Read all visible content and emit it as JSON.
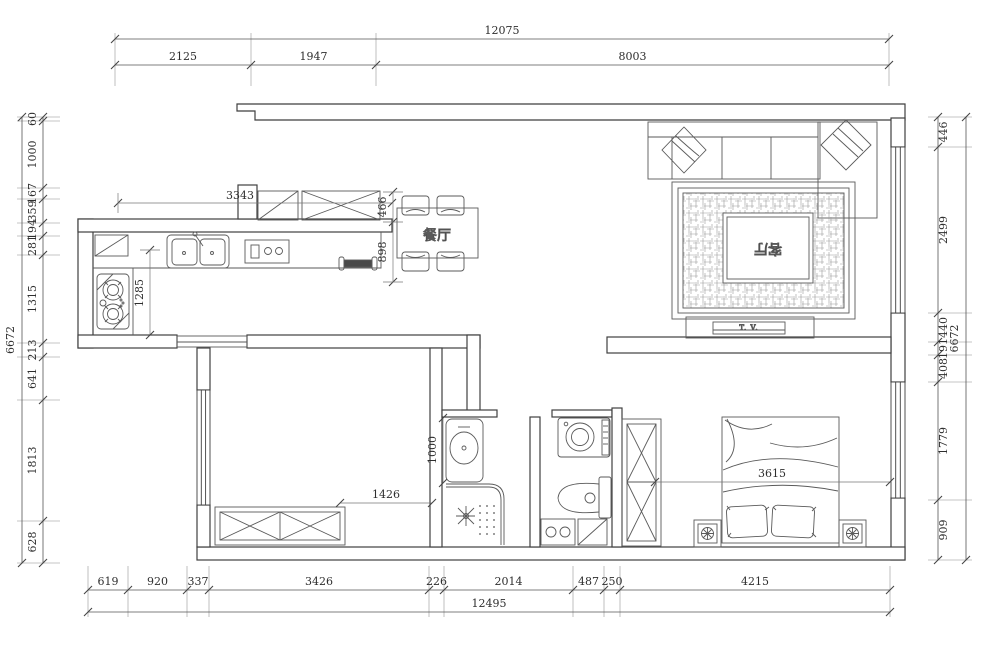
{
  "drawing": {
    "type": "apartment floor plan",
    "line_color": "#3f3f3f",
    "furniture_color": "#5a5a5a",
    "dim_color": "#2e2e2e"
  },
  "rooms": {
    "dining_label": "餐厅",
    "living_label": "客厅",
    "tv_label": "T. V."
  },
  "dims": {
    "top": {
      "overall": "12075",
      "segments": [
        "2125",
        "1947",
        "8003"
      ]
    },
    "bottom": {
      "overall": "12495",
      "segments": [
        "619",
        "920",
        "337",
        "3426",
        "226",
        "2014",
        "487",
        "250",
        "4215"
      ]
    },
    "left": {
      "overall": "6672",
      "segments": [
        "60",
        "1000",
        "167",
        "359",
        "194",
        "281",
        "1315",
        "213",
        "641",
        "1813",
        "628"
      ]
    },
    "right": {
      "overall": "6672",
      "segments": [
        "446",
        "2499",
        "440",
        "191",
        "408",
        "1779",
        "909"
      ]
    },
    "interior": {
      "kitchen_width": "3343",
      "kitchen_depth": "1285",
      "dining_upper": "466",
      "dining_lower": "898",
      "bath_width": "1000",
      "bedroom1_width": "1426",
      "bedroom2_width": "3615"
    }
  }
}
